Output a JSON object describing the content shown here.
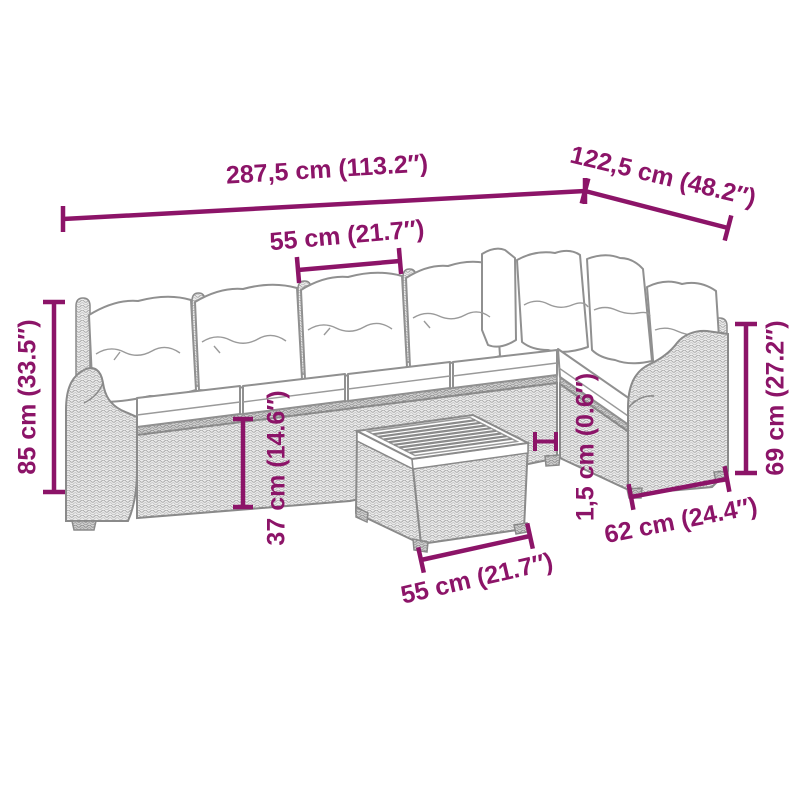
{
  "palette": {
    "accent": "#8C1468",
    "artwork_line": "#8a8a8a",
    "background": "#ffffff"
  },
  "dimensions": {
    "total_width": "287,5 cm (113.2″)",
    "wing_depth": "122,5 cm (48.2″)",
    "seat_width": "55 cm (21.7″)",
    "back_height": "85 cm (33.5″)",
    "seat_height": "37 cm (14.6″)",
    "top_thickness": "1,5 cm (0.6″)",
    "armrest_height": "69 cm (27.2″)",
    "armrest_depth": "62 cm (24.4″)",
    "table_width": "55 cm (21.7″)"
  }
}
